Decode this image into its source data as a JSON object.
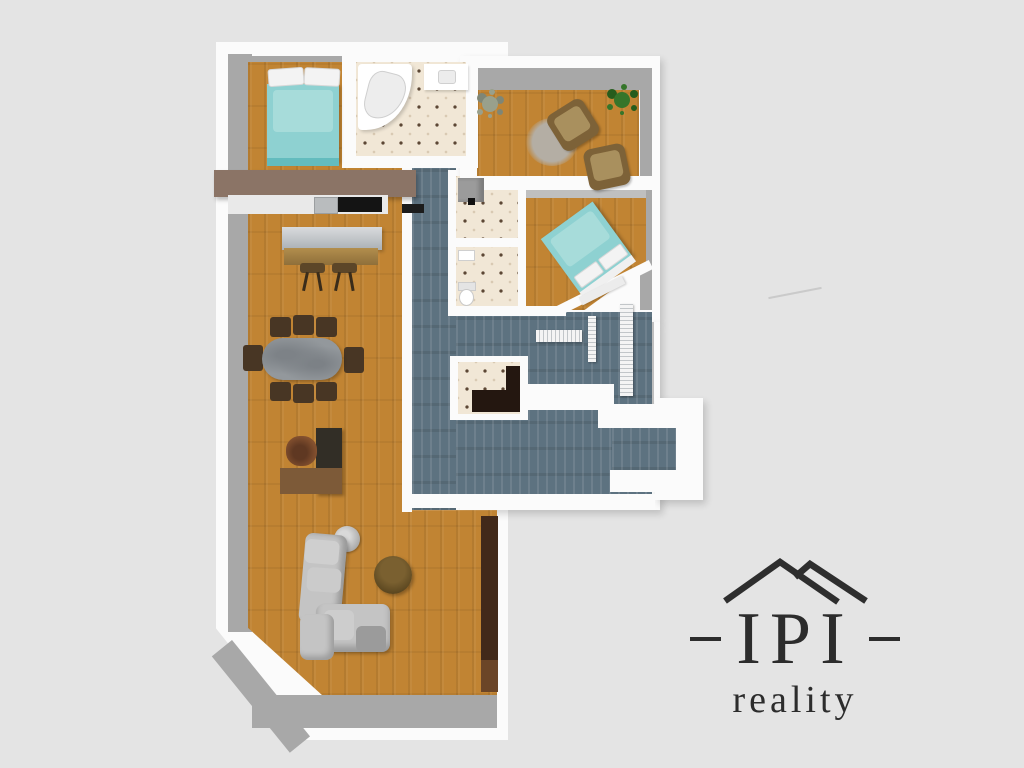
{
  "logo": {
    "brand": "IPI",
    "tagline": "reality",
    "color": "#2c2c2c"
  },
  "palette": {
    "bg": "#e4e4e4",
    "wall": "#fbfbfb",
    "wallFace": "#a8a8a8",
    "wallFaceLight": "#bfbfbf",
    "wood": "#c18433",
    "slate": "#5d7280",
    "tile": "#f1e7d6",
    "teal": "#8ed1d1",
    "tealLight": "#a7dcda",
    "tealDark": "#63bcbe",
    "counter": "#8b7466",
    "counterLight": "#e9e9e9",
    "cooktop": "#141414",
    "sink": "#b9bcbe",
    "islandTop": "#c3c7ca",
    "islandWood": "#b28e4d",
    "stool": "#5c4628",
    "tableTop": "#93989c",
    "chair": "#483624",
    "deskDark": "#322e26",
    "deskWood": "#7d5a38",
    "officeChair": "#85512f",
    "sofa": "#c4c4c4",
    "sofaDark": "#9b9b9b",
    "coffee": "#6b5327",
    "unit": "#42291a",
    "unitLight": "#6b4527",
    "palm": "#35752a",
    "palmDark": "#265c1c",
    "grayPlant": "#99a08c",
    "grayPlantDark": "#7f8676",
    "rug": "#b4aea4",
    "radiator": "#f4f4f4",
    "fixture": "#ffffff",
    "cabinetGray": "#9b9b9b",
    "darkCounter": "#241710",
    "logo": "#2c2c2c",
    "scratch": "#c6c6c6"
  },
  "scene": {
    "type": "3d-top-down-apartment-floor-plan-render",
    "rooms": [
      {
        "name": "bedroom-1",
        "floor": "wood",
        "furniture": [
          "double-bed-teal"
        ]
      },
      {
        "name": "bathroom",
        "floor": "tile",
        "fixtures": [
          "corner-bathtub",
          "vanity-sink"
        ]
      },
      {
        "name": "open-kitchen-living-dining",
        "floor": "wood",
        "furniture": [
          "kitchen-counter-with-cooktop",
          "island-with-bar-stools",
          "dining-table-with-eight-chairs",
          "l-shaped-desk",
          "office-chair",
          "l-shaped-sofa",
          "floor-lamp",
          "round-coffee-table",
          "tall-wall-unit"
        ]
      },
      {
        "name": "sitting-room",
        "floor": "wood",
        "furniture": [
          "armchair",
          "armchair",
          "round-rug",
          "gray-plant",
          "palm-plant"
        ]
      },
      {
        "name": "bedroom-2",
        "floor": "wood",
        "furniture": [
          "double-bed-teal-diagonal",
          "bench"
        ]
      },
      {
        "name": "utility-room",
        "floor": "tile",
        "fixtures": [
          "cabinet"
        ]
      },
      {
        "name": "wc",
        "floor": "tile",
        "fixtures": [
          "toilet",
          "hand-basin"
        ]
      },
      {
        "name": "pantry",
        "floor": "tile",
        "fixtures": [
          "l-shaped-dark-counter"
        ]
      },
      {
        "name": "hallway",
        "floor": "slate",
        "fixtures": [
          "radiator",
          "radiator",
          "radiator"
        ]
      },
      {
        "name": "entry-corridor",
        "floor": "slate"
      }
    ]
  }
}
